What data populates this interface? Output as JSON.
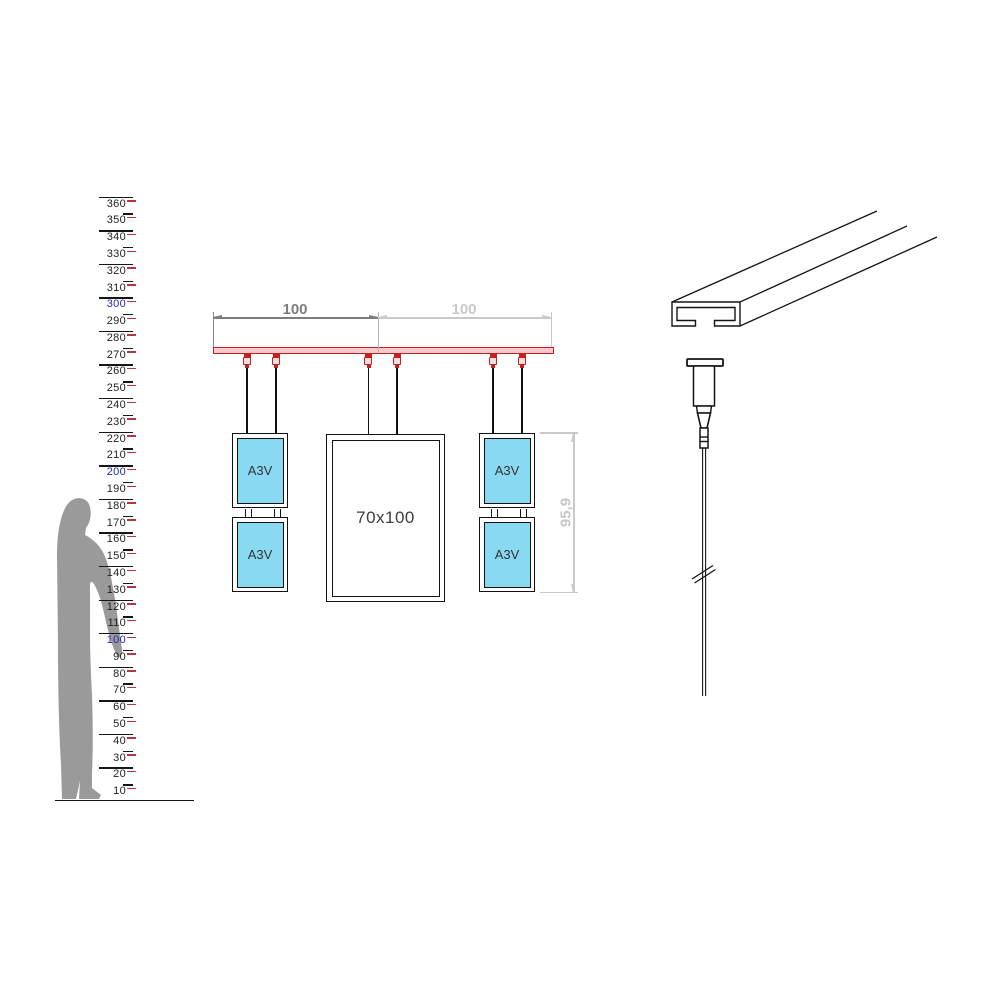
{
  "ruler": {
    "values": [
      360,
      350,
      340,
      330,
      320,
      310,
      300,
      290,
      280,
      270,
      260,
      250,
      240,
      230,
      220,
      210,
      200,
      190,
      180,
      170,
      160,
      150,
      140,
      130,
      120,
      110,
      100,
      90,
      80,
      70,
      60,
      50,
      40,
      30,
      20,
      10
    ],
    "blue_values": [
      300,
      200,
      100
    ],
    "number_color": "#1f1f1f",
    "blue_color": "#2626b0",
    "red_tick_color": "#b23742"
  },
  "drawing": {
    "dimensions": {
      "left_span_label": "100",
      "right_span_label": "100",
      "stack_height_label": "95,9",
      "dark_color": "#7d7d7d",
      "light_color": "#c9c9c9"
    },
    "panels": {
      "a3v_label": "A3V",
      "poster_label": "70x100",
      "panel_fill": "#8ad9f2"
    },
    "rail": {
      "stroke": "#c52020",
      "fill": "#f7c9c9"
    }
  },
  "figure": {
    "fill": "#9a9a9a"
  }
}
